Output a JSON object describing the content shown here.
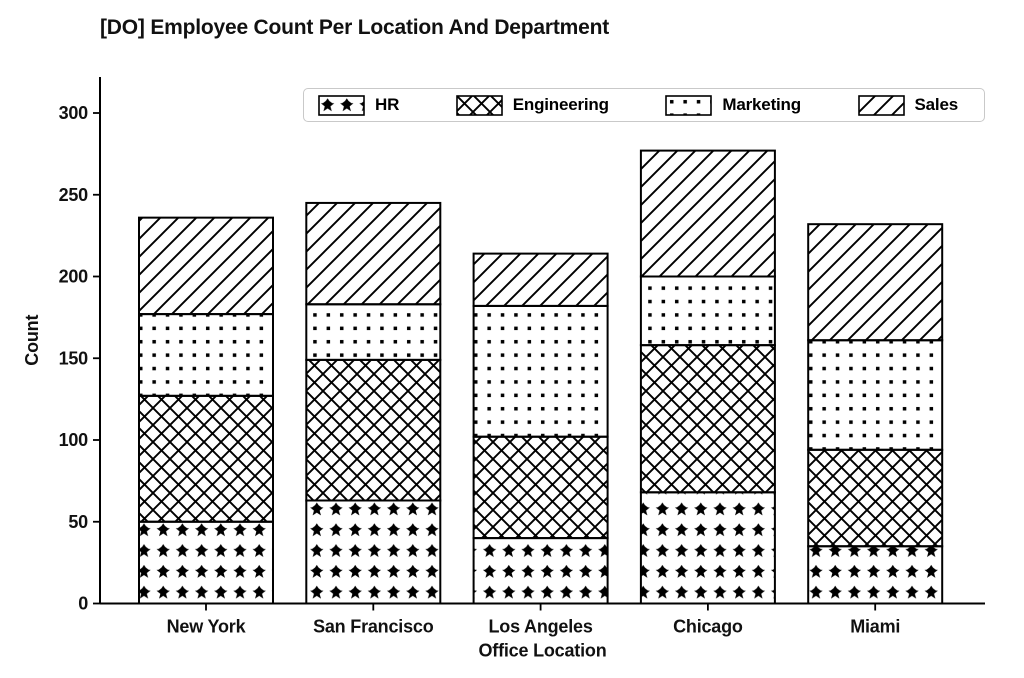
{
  "title": "[DO] Employee Count Per Location And Department",
  "axes": {
    "xlabel": "Office Location",
    "ylabel": "Count"
  },
  "chart_data": {
    "type": "bar",
    "stacked": true,
    "title": "[DO] Employee Count Per Location And Department",
    "xlabel": "Office Location",
    "ylabel": "Count",
    "categories": [
      "New York",
      "San Francisco",
      "Los Angeles",
      "Chicago",
      "Miami"
    ],
    "series": [
      {
        "name": "HR",
        "hatch": "stars",
        "values": [
          50,
          63,
          40,
          68,
          35
        ]
      },
      {
        "name": "Engineering",
        "hatch": "crosshatch",
        "values": [
          77,
          86,
          62,
          90,
          59
        ]
      },
      {
        "name": "Marketing",
        "hatch": "dots",
        "values": [
          50,
          34,
          80,
          42,
          67
        ]
      },
      {
        "name": "Sales",
        "hatch": "diagonal",
        "values": [
          59,
          62,
          32,
          77,
          71
        ]
      }
    ],
    "totals": [
      236,
      245,
      214,
      277,
      232
    ],
    "yticks": [
      0,
      50,
      100,
      150,
      200,
      250,
      300
    ],
    "ylim": [
      0,
      322
    ],
    "grid": false,
    "legend_position": "upper center, horizontal, inside axes",
    "colors": {
      "foreground": "#000000",
      "background": "#ffffff",
      "legend_border": "#c9c9c9"
    }
  }
}
